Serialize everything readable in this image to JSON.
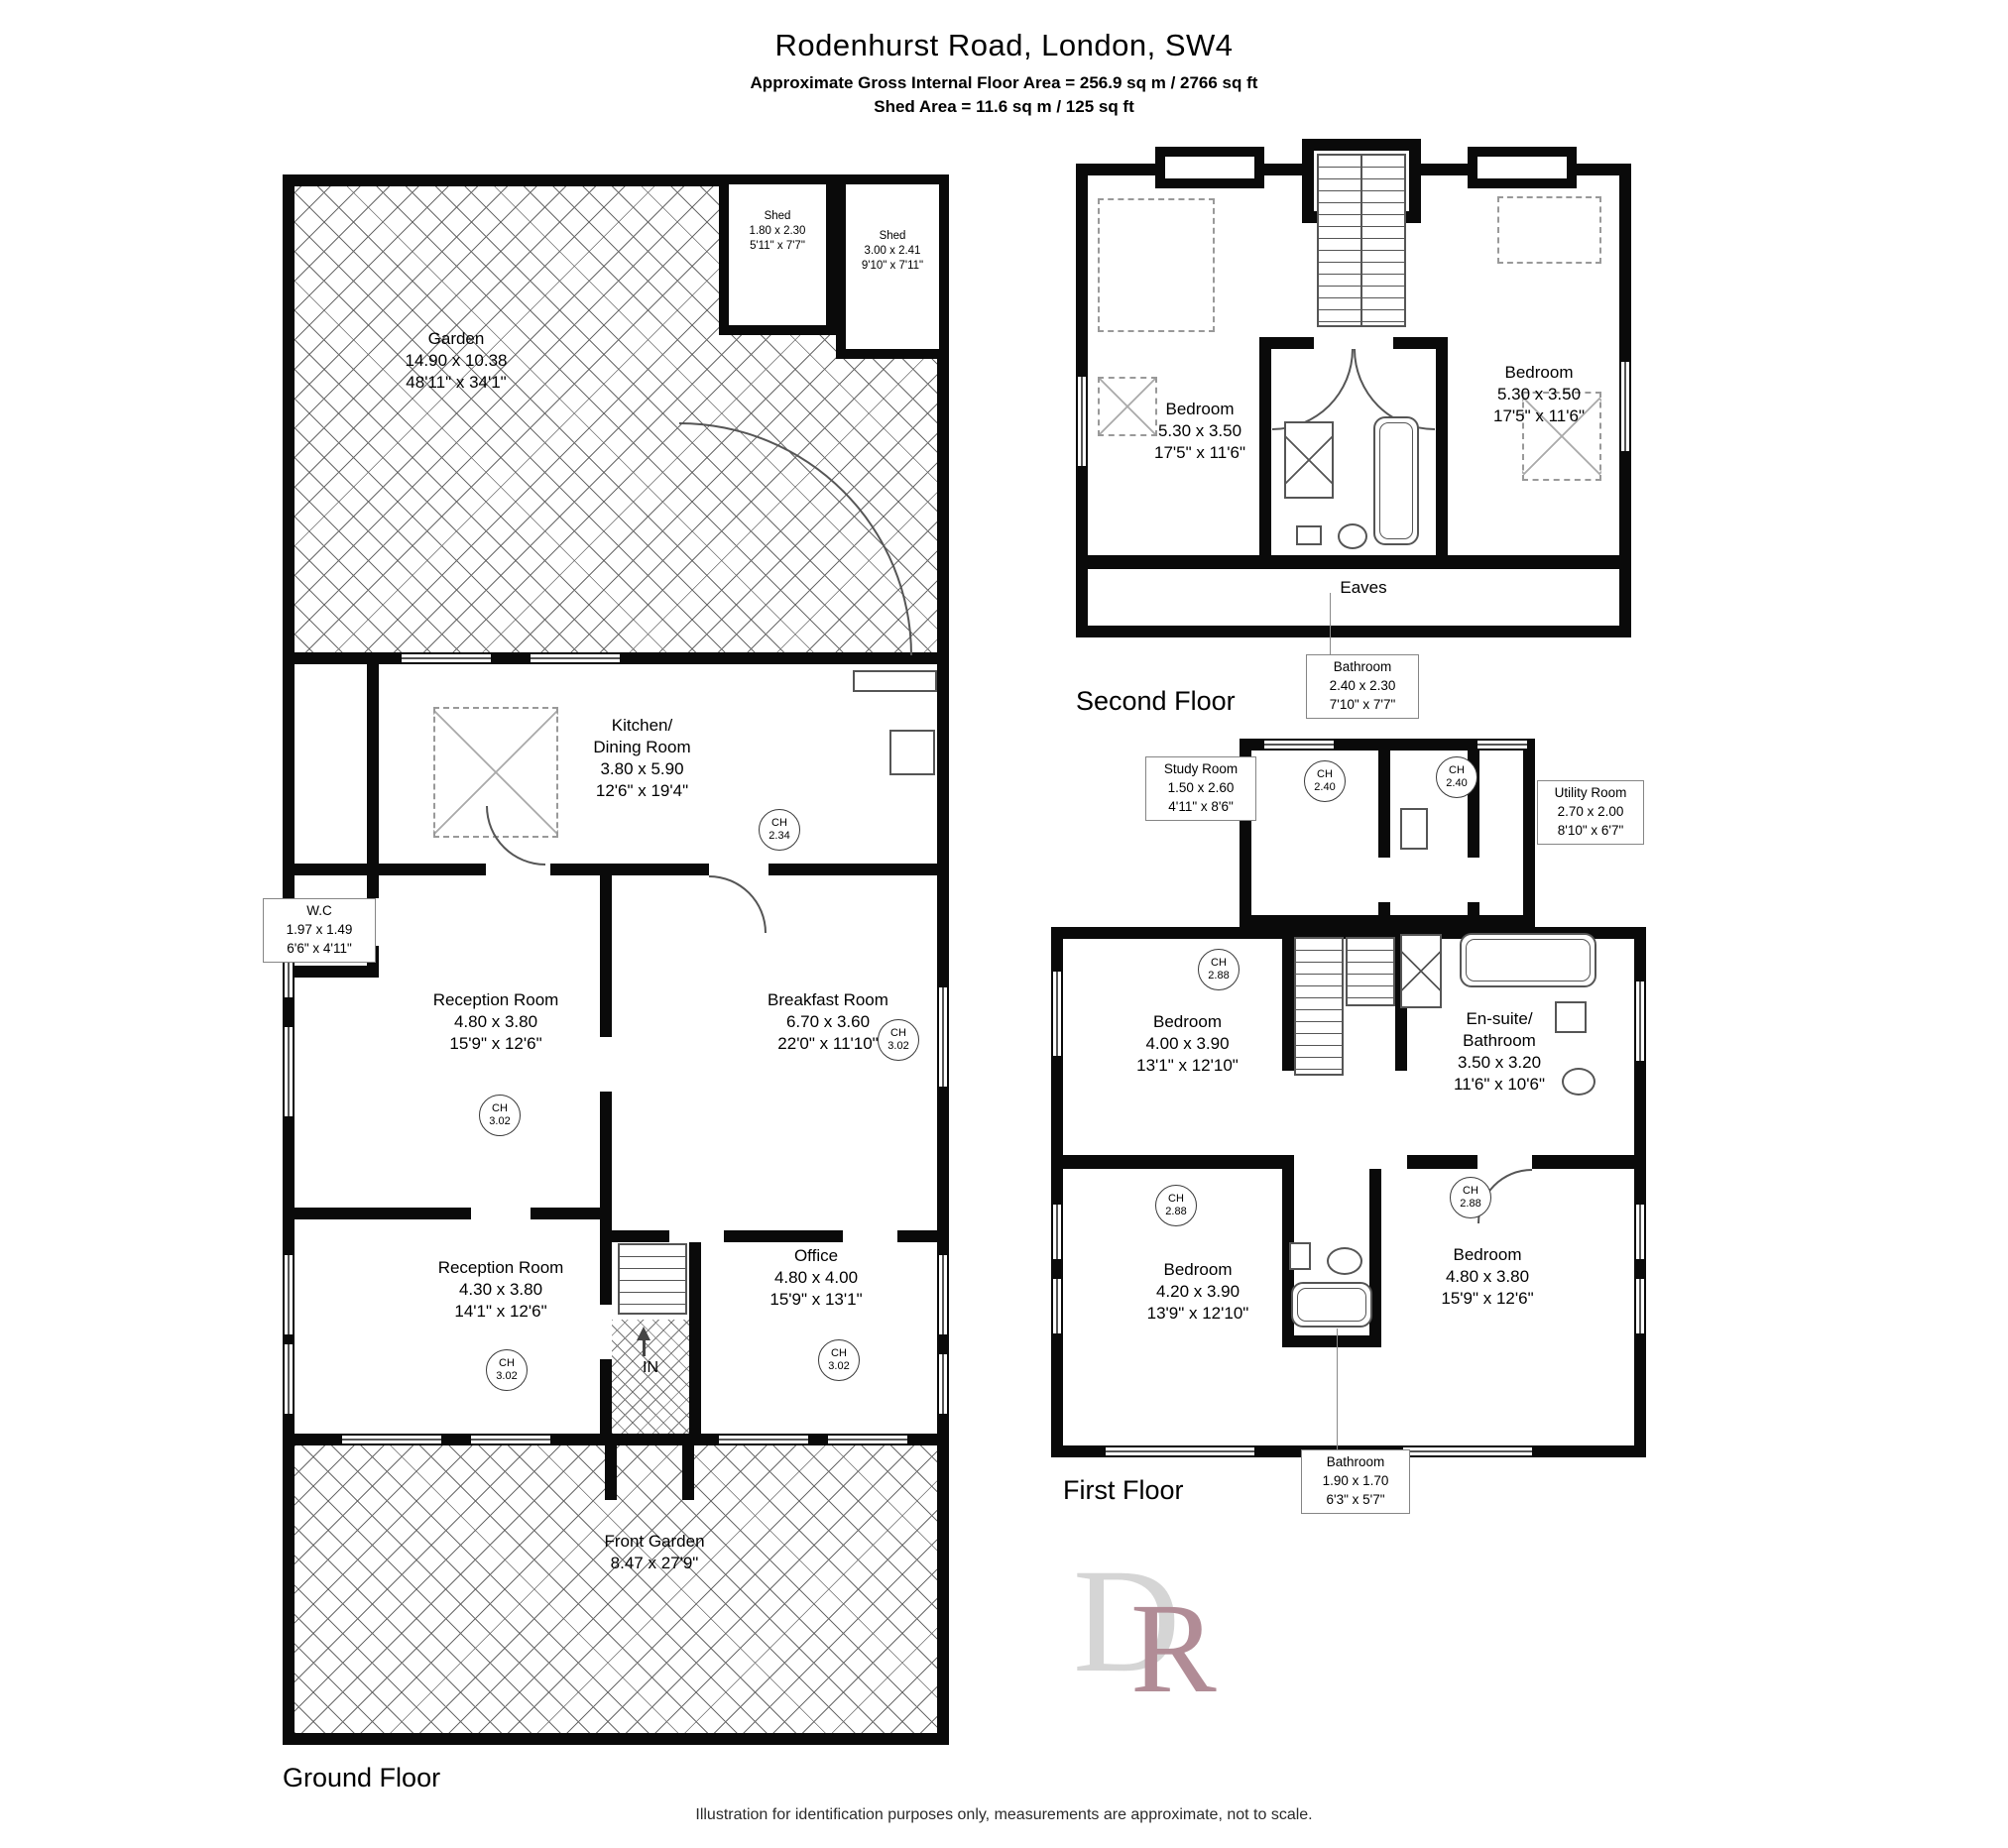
{
  "header": {
    "title": "Rodenhurst Road, London, SW4",
    "subtitle1": "Approximate Gross Internal Floor Area = 256.9 sq m / 2766 sq ft",
    "subtitle2": "Shed Area = 11.6 sq m / 125 sq ft"
  },
  "ch_label": "CH",
  "ground_floor": {
    "label": "Ground Floor",
    "garden": {
      "name": "Garden",
      "metric": "14.90 x 10.38",
      "imperial": "48'11\" x 34'1\""
    },
    "shed1": {
      "name": "Shed",
      "metric": "1.80 x 2.30",
      "imperial": "5'11\" x 7'7\""
    },
    "shed2": {
      "name": "Shed",
      "metric": "3.00 x 2.41",
      "imperial": "9'10\" x 7'11\""
    },
    "kitchen": {
      "name1": "Kitchen/",
      "name2": "Dining Room",
      "metric": "3.80 x 5.90",
      "imperial": "12'6\" x 19'4\"",
      "ch": "2.34"
    },
    "wc": {
      "name": "W.C",
      "metric": "1.97 x 1.49",
      "imperial": "6'6\" x 4'11\""
    },
    "reception1": {
      "name": "Reception Room",
      "metric": "4.80 x 3.80",
      "imperial": "15'9\" x 12'6\"",
      "ch": "3.02"
    },
    "breakfast": {
      "name": "Breakfast Room",
      "metric": "6.70 x 3.60",
      "imperial": "22'0\" x 11'10\"",
      "ch": "3.02"
    },
    "reception2": {
      "name": "Reception Room",
      "metric": "4.30 x 3.80",
      "imperial": "14'1\" x 12'6\"",
      "ch": "3.02"
    },
    "office": {
      "name": "Office",
      "metric": "4.80 x 4.00",
      "imperial": "15'9\" x 13'1\"",
      "ch": "3.02"
    },
    "front_garden": {
      "name": "Front Garden",
      "metric": "8.47 x 27'9\""
    },
    "entrance": "IN"
  },
  "second_floor": {
    "label": "Second Floor",
    "bedroom_left": {
      "name": "Bedroom",
      "metric": "5.30 x 3.50",
      "imperial": "17'5\" x 11'6\""
    },
    "bedroom_right": {
      "name": "Bedroom",
      "metric": "5.30 x 3.50",
      "imperial": "17'5\" x 11'6\""
    },
    "eaves": "Eaves",
    "bathroom": {
      "name": "Bathroom",
      "metric": "2.40 x 2.30",
      "imperial": "7'10\" x 7'7\""
    }
  },
  "first_floor": {
    "label": "First Floor",
    "study": {
      "name": "Study Room",
      "metric": "1.50 x 2.60",
      "imperial": "4'11\" x 8'6\""
    },
    "utility": {
      "name": "Utility Room",
      "metric": "2.70 x 2.00",
      "imperial": "8'10\" x 6'7\""
    },
    "ch_hall_left": "2.40",
    "ch_hall_right": "2.40",
    "bedroom_top": {
      "name": "Bedroom",
      "metric": "4.00 x 3.90",
      "imperial": "13'1\" x 12'10\"",
      "ch": "2.88"
    },
    "ensuite": {
      "name1": "En-suite/",
      "name2": "Bathroom",
      "metric": "3.50 x 3.20",
      "imperial": "11'6\" x 10'6\""
    },
    "bedroom_left": {
      "name": "Bedroom",
      "metric": "4.20 x 3.90",
      "imperial": "13'9\" x 12'10\"",
      "ch": "2.88"
    },
    "bedroom_right": {
      "name": "Bedroom",
      "metric": "4.80 x 3.80",
      "imperial": "15'9\" x 12'6\"",
      "ch": "2.88"
    },
    "bathroom": {
      "name": "Bathroom",
      "metric": "1.90 x 1.70",
      "imperial": "6'3\" x 5'7\""
    }
  },
  "logo": {
    "letter_d": "D",
    "letter_r": "R",
    "color_d": "#d5d5d5",
    "color_r": "#b18c96"
  },
  "footer": {
    "disclaimer": "Illustration for identification purposes only, measurements are approximate, not to scale."
  }
}
